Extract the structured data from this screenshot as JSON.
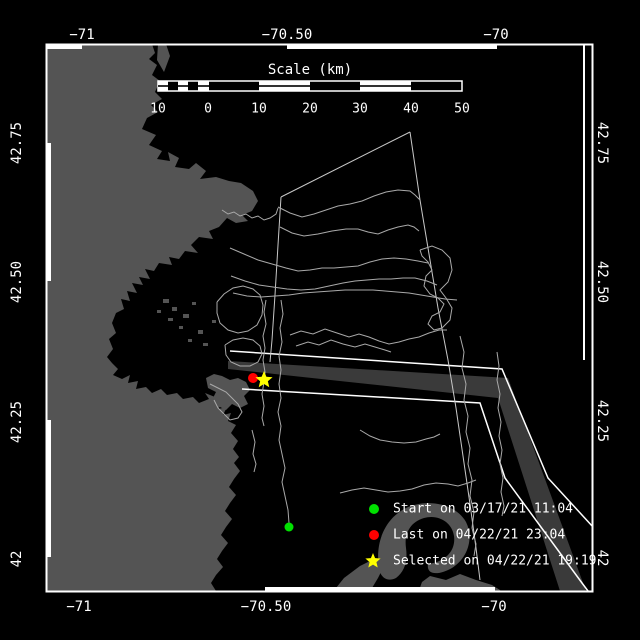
{
  "colors": {
    "background": "#000000",
    "frame": "#ffffff",
    "land": "#545454",
    "sea": "#000000",
    "track": "#a9a9a9",
    "survey_line": "#c8c8c8",
    "lane": "#3a3a3a",
    "lane_boundary": "#ffffff",
    "text": "#ffffff"
  },
  "axes": {
    "top_labels": [
      {
        "text": "−71"
      },
      {
        "text": "−70.50"
      },
      {
        "text": "−70"
      }
    ],
    "bottom_labels": [
      {
        "text": "−71"
      },
      {
        "text": "−70.50"
      },
      {
        "text": "−70"
      }
    ],
    "left_labels": [
      {
        "text": "42.75"
      },
      {
        "text": "42.50"
      },
      {
        "text": "42.25"
      },
      {
        "text": "42"
      }
    ],
    "right_labels": [
      {
        "text": "42.75"
      },
      {
        "text": "42.50"
      },
      {
        "text": "42.25"
      },
      {
        "text": "42"
      }
    ]
  },
  "scalebar": {
    "title": "Scale (km)",
    "tick_labels": [
      "10",
      "0",
      "10",
      "20",
      "30",
      "40",
      "50"
    ]
  },
  "legend": {
    "items": [
      {
        "marker": "circle",
        "color": "#00e000",
        "label": "Start on 03/17/21 11:04"
      },
      {
        "marker": "circle",
        "color": "#ff0000",
        "label": "Last on 04/22/21 23:04"
      },
      {
        "marker": "star",
        "color": "#ffff00",
        "label": "Selected on 04/22/21 19:19"
      }
    ]
  },
  "map_markers": {
    "start": {
      "color": "#00e000"
    },
    "last": {
      "color": "#ff0000"
    },
    "selected": {
      "color": "#ffff00"
    }
  }
}
